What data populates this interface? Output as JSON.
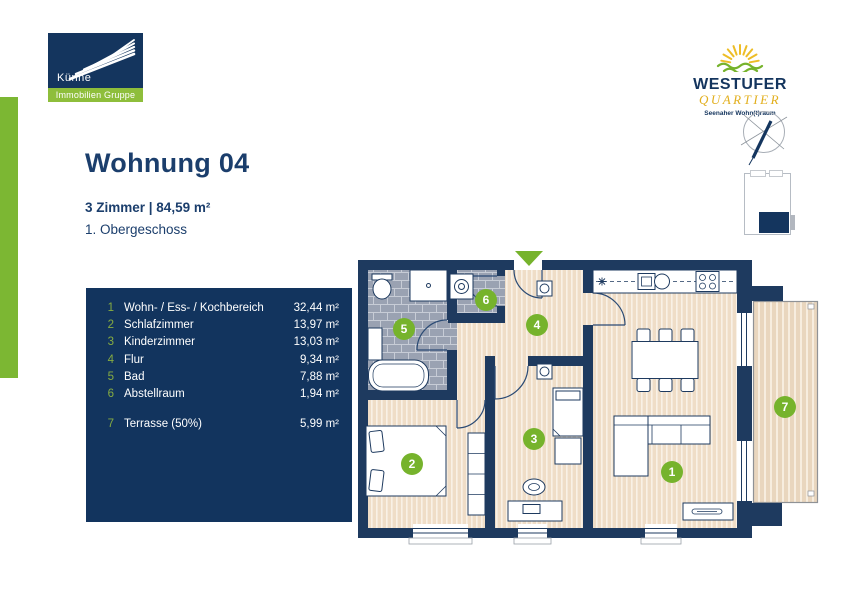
{
  "brand": {
    "kuenne": {
      "name": "Künne",
      "tagline": "Immobilien Gruppe"
    },
    "westufer": {
      "name_line1": "WESTUFER",
      "name_line2": "QUARTIER",
      "tagline": "Seenaher Wohn(t)raum"
    }
  },
  "header": {
    "title": "Wohnung 04",
    "details": "3 Zimmer | 84,59 m²",
    "floor": "1. Obergeschoss"
  },
  "legend": {
    "rooms": [
      {
        "number": "1",
        "name": "Wohn- / Ess- / Kochbereich",
        "area": "32,44 m²"
      },
      {
        "number": "2",
        "name": "Schlafzimmer",
        "area": "13,97 m²"
      },
      {
        "number": "3",
        "name": "Kinderzimmer",
        "area": "13,03 m²"
      },
      {
        "number": "4",
        "name": "Flur",
        "area": "9,34 m²"
      },
      {
        "number": "5",
        "name": "Bad",
        "area": "7,88 m²"
      },
      {
        "number": "6",
        "name": "Abstellraum",
        "area": "1,94 m²"
      },
      {
        "number": "7",
        "name": "Terrasse (50%)",
        "area": "5,99 m²"
      }
    ]
  },
  "colors": {
    "navy": "#14355e",
    "green": "#76b32c",
    "gold": "#e2af1e"
  }
}
